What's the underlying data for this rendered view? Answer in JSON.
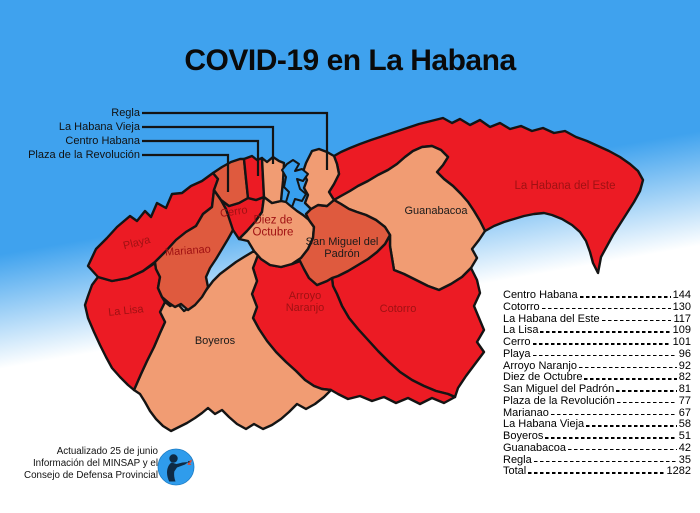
{
  "title": "COVID-19 en La Habana",
  "colors": {
    "sky": "#3FA2EE",
    "high": "#EC1B24",
    "medium": "#DF5A3E",
    "low": "#F19C73",
    "bay": "#379FEF",
    "label_dark_red": "#A01113"
  },
  "callouts": [
    {
      "label": "Regla"
    },
    {
      "label": "La Habana Vieja"
    },
    {
      "label": "Centro Habana"
    },
    {
      "label": "Plaza de la Revolución"
    }
  ],
  "map_labels": [
    {
      "text": "Playa"
    },
    {
      "text": "Marianao"
    },
    {
      "text": "La Lisa"
    },
    {
      "text": "Cerro"
    },
    {
      "text": "Diez de Octubre"
    },
    {
      "text": "Boyeros"
    },
    {
      "text": "Arroyo Naranjo"
    },
    {
      "text": "San Miguel del Padrón"
    },
    {
      "text": "Guanabacoa"
    },
    {
      "text": "Cotorro"
    },
    {
      "text": "La Habana del Este"
    }
  ],
  "regions": [
    {
      "name": "Playa",
      "level": "high"
    },
    {
      "name": "Marianao",
      "level": "medium"
    },
    {
      "name": "La Lisa",
      "level": "high"
    },
    {
      "name": "Cerro",
      "level": "high"
    },
    {
      "name": "Diez de Octubre",
      "level": "low"
    },
    {
      "name": "Boyeros",
      "level": "low"
    },
    {
      "name": "Arroyo Naranjo",
      "level": "high"
    },
    {
      "name": "San Miguel del Padrón",
      "level": "medium"
    },
    {
      "name": "Guanabacoa",
      "level": "low"
    },
    {
      "name": "Cotorro",
      "level": "high"
    },
    {
      "name": "La Habana del Este",
      "level": "high"
    },
    {
      "name": "Plaza de la Revolución",
      "level": "medium"
    },
    {
      "name": "Centro Habana",
      "level": "high"
    },
    {
      "name": "La Habana Vieja",
      "level": "low"
    },
    {
      "name": "Regla",
      "level": "low"
    }
  ],
  "stats": {
    "rows": [
      {
        "name": "Centro Habana",
        "value": "144"
      },
      {
        "name": "Cotorro",
        "value": "130"
      },
      {
        "name": "La Habana del Este",
        "value": "117"
      },
      {
        "name": "La Lisa",
        "value": "109"
      },
      {
        "name": "Cerro",
        "value": "101"
      },
      {
        "name": "Playa",
        "value": "96"
      },
      {
        "name": "Arroyo Naranjo",
        "value": "92"
      },
      {
        "name": "Diez de Octubre",
        "value": "82"
      },
      {
        "name": "San Miguel del Padrón",
        "value": "81"
      },
      {
        "name": "Plaza de la Revolución",
        "value": "77"
      },
      {
        "name": "Marianao",
        "value": "67"
      },
      {
        "name": "La Habana Vieja",
        "value": "58"
      },
      {
        "name": "Boyeros",
        "value": "51"
      },
      {
        "name": "Guanabacoa",
        "value": "42"
      },
      {
        "name": "Regla",
        "value": "35"
      },
      {
        "name": "Total",
        "value": "1282"
      }
    ]
  },
  "footer": {
    "line1": "Actualizado 25 de junio",
    "line2": "Información del MINSAP y el",
    "line3": "Consejo de Defensa Provincial"
  }
}
